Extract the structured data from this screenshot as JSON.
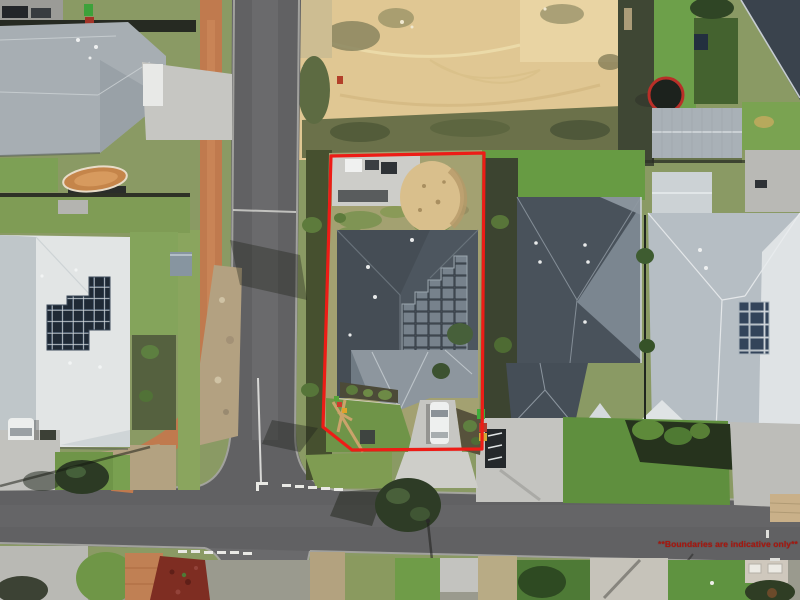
{
  "scene": {
    "type": "aerial-drone-photograph",
    "subject": "residential property with red boundary outline, new estate street",
    "disclaimer_text": "**Boundaries are indicative only**",
    "boundary_color": "#ed1c16",
    "disclaimer_color": "#a7170e"
  },
  "palette": {
    "road": "#616163",
    "road_south": "#6a6a6c",
    "sand_lot": "#e0c793",
    "grass_bright": "#6f9c48",
    "grass_dry": "#a3a171",
    "roof_dark_slate": "#454d55",
    "roof_light_grey": "#a7aeb3",
    "roof_white": "#e2e5e5",
    "roof_silver": "#b6bec4",
    "concrete": "#c6c6c2",
    "brick_path": "#c07a4e",
    "solar_panel_dark": "#1f2935",
    "solar_panel_light": "#77828c",
    "red_mulch": "#7e2d22",
    "tree_dark": "#2e3c26",
    "trampoline_ring": "#b92f28",
    "car_white": "#eef0ef"
  }
}
